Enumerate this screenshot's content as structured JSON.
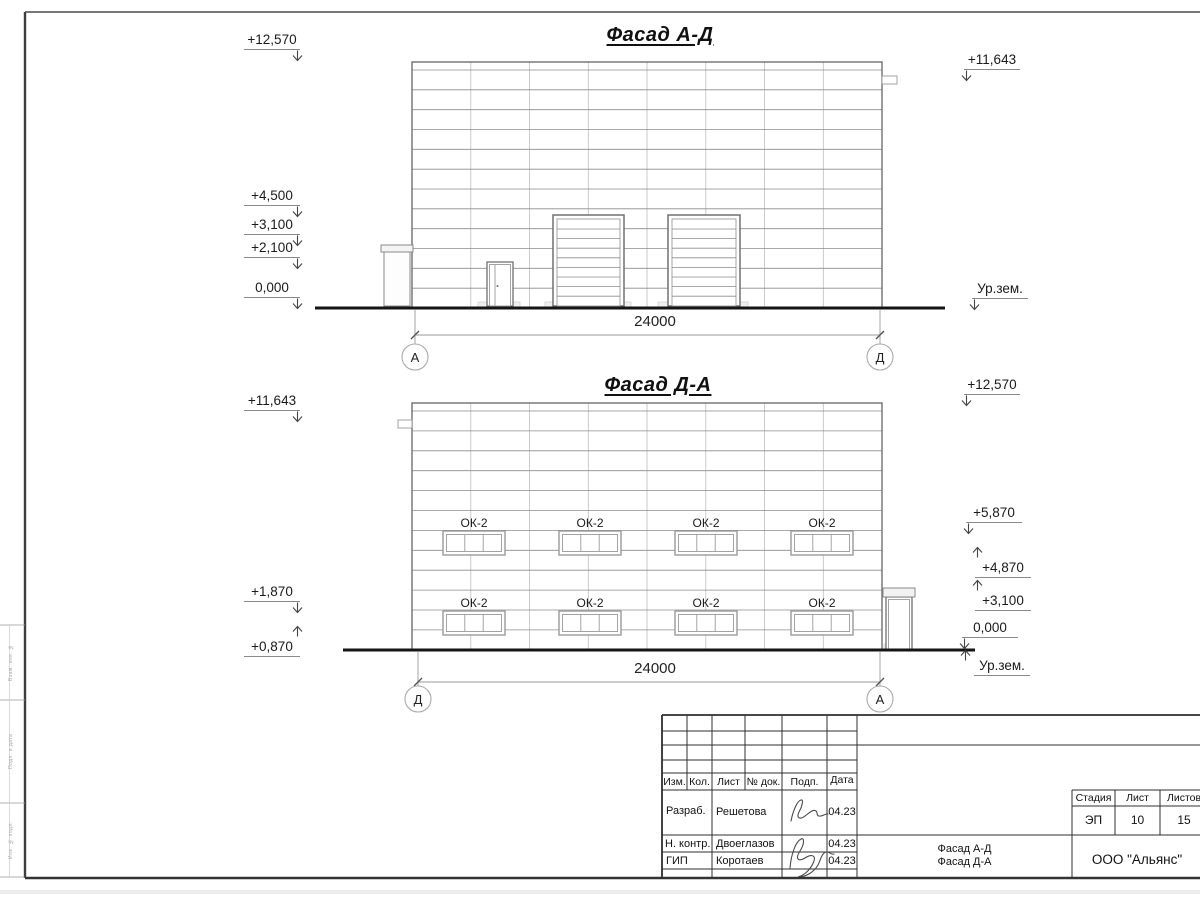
{
  "frame": {
    "margin_labels": [
      "Взам. инв. №",
      "Подп. и дата",
      "Инв. № подл."
    ]
  },
  "facade1": {
    "title": "Фасад А-Д",
    "dim": "24000",
    "axis_left": "А",
    "axis_right": "Д",
    "marks_left": [
      "+12,570",
      "+4,500",
      "+3,100",
      "+2,100",
      "0,000"
    ],
    "marks_right": [
      "+11,643",
      "Ур.зем."
    ]
  },
  "facade2": {
    "title": "Фасад Д-А",
    "dim": "24000",
    "axis_left": "Д",
    "axis_right": "А",
    "window_label": "ОК-2",
    "marks_left": [
      "+11,643",
      "+1,870",
      "+0,870"
    ],
    "marks_right": [
      "+12,570",
      "+5,870",
      "+4,870",
      "+3,100",
      "0,000",
      "Ур.зем."
    ]
  },
  "titleblock": {
    "header": [
      "Изм.",
      "Кол.",
      "Лист",
      "№ док.",
      "Подп.",
      "Дата"
    ],
    "rows": [
      {
        "role": "Разраб.",
        "name": "Решетова",
        "date": "04.23"
      },
      {
        "role": "Н. контр.",
        "name": "Двоеглазов",
        "date": "04.23"
      },
      {
        "role": "ГИП",
        "name": "Коротаев",
        "date": "04.23"
      }
    ],
    "doc_title": [
      "Фасад А-Д",
      "Фасад Д-А"
    ],
    "company": "ООО \"Альянс\"",
    "stage_label": "Стадия",
    "sheet_label": "Лист",
    "sheets_label": "Листов",
    "stage": "ЭП",
    "sheet_no": "10",
    "sheets_total": "15"
  }
}
